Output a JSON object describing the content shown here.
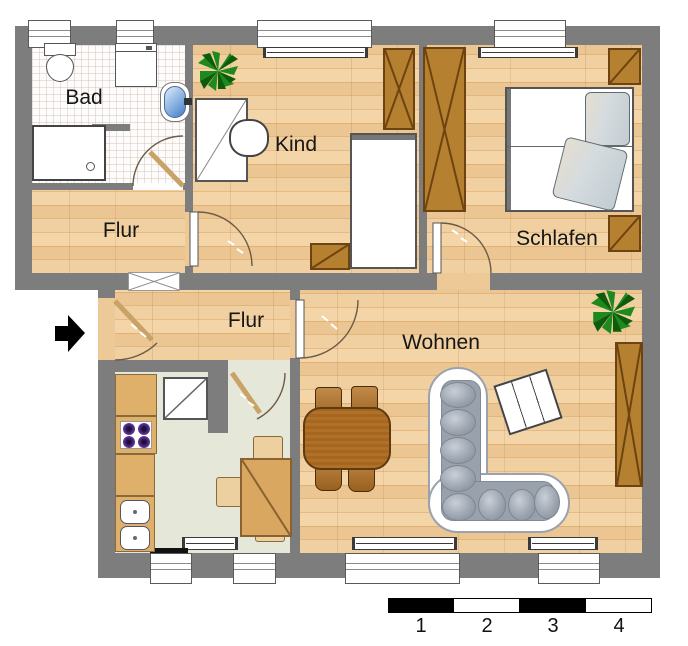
{
  "rooms": {
    "bad": {
      "label": "Bad"
    },
    "flur_upper": {
      "label": "Flur"
    },
    "kind": {
      "label": "Kind"
    },
    "schlafen": {
      "label": "Schlafen"
    },
    "flur_lower": {
      "label": "Flur"
    },
    "wohnen": {
      "label": "Wohnen"
    }
  },
  "scale_bar": {
    "labels": [
      "1",
      "2",
      "3",
      "4"
    ]
  },
  "entrance": {
    "symbol": "arrow-right"
  },
  "colors": {
    "wall": "#7d7d7d",
    "wood_floor": "#ecc692",
    "kitchen_floor": "#e5e7d8",
    "bath_floor": "#fdfcfb",
    "furniture_wood": "#b5802f",
    "sofa_cushion": "#99a1ad",
    "stove_burner": "#5b2f91",
    "sink_blue": "#6f9fd8",
    "duvet": "#ccd5d9",
    "plant_green": "#1e8a1e",
    "text": "#161616"
  },
  "furniture": {
    "bad": [
      "toilet",
      "washing-machine",
      "sink",
      "shower"
    ],
    "kind": [
      "plant",
      "desk",
      "desk-chair",
      "wardrobe",
      "bed",
      "side-table"
    ],
    "schlafen": [
      "wardrobe",
      "double-bed",
      "cabinet",
      "cabinet"
    ],
    "kueche": [
      "counter",
      "stove",
      "sink-unit",
      "cabinet",
      "table",
      "chairs"
    ],
    "wohnen": [
      "dining-table",
      "chairs",
      "corner-sofa",
      "coffee-table",
      "plant",
      "shelf"
    ]
  }
}
